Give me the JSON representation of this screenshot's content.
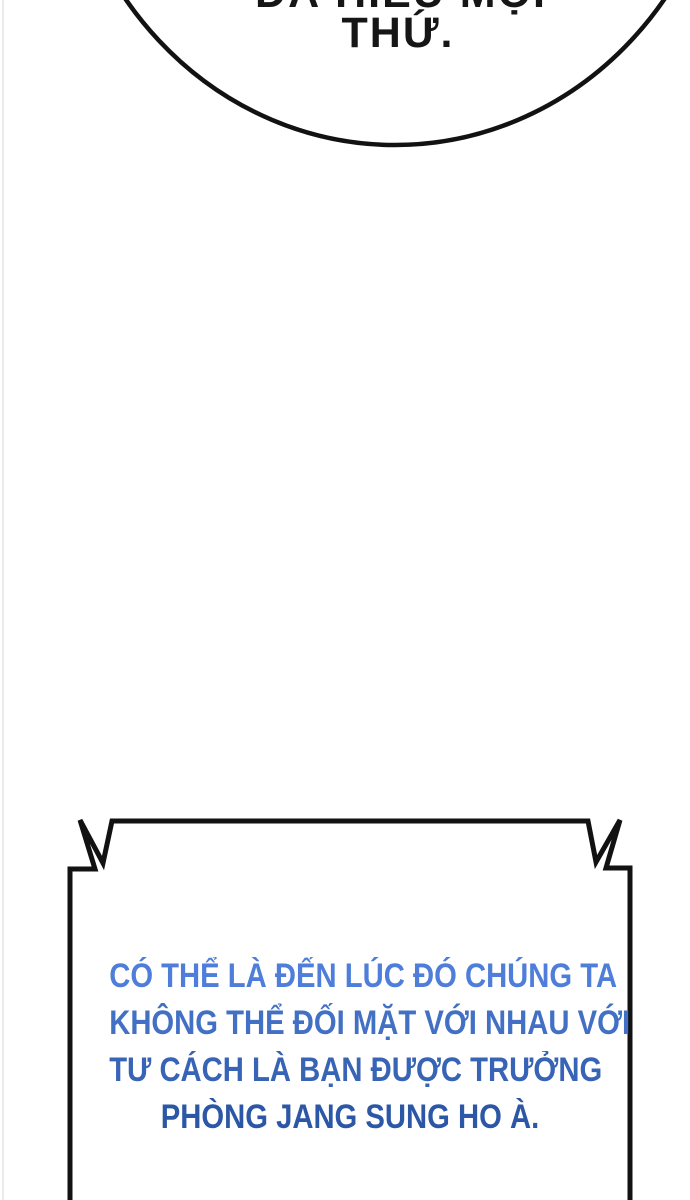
{
  "page": {
    "background_color": "#ffffff",
    "left_edge_line_color": "#eaeaea"
  },
  "top_speech_bubble": {
    "shape": "ellipse-cut-off-at-top",
    "outline_color": "#121212",
    "fill_color": "#ffffff",
    "partial_line_text": "ĐÃ HIỂU MỌI",
    "main_line_text": "THỨ.",
    "text_color": "#161616"
  },
  "dialog_box": {
    "shape": "flash-rectangle-cut-off-at-bottom",
    "outline_color": "#121212",
    "fill_color": "#ffffff",
    "lines": [
      {
        "text": "CÓ THỂ LÀ ĐẾN LÚC ĐÓ CHÚNG TA",
        "color": "#4e7ed9"
      },
      {
        "text": "KHÔNG THỂ ĐỐI MẶT VỚI NHAU VỚI",
        "color": "#4270c4"
      },
      {
        "text": "TƯ CÁCH LÀ BẠN ĐƯỢC TRƯỞNG",
        "color": "#3764b5"
      },
      {
        "text": "PHÒNG JANG SUNG HO À.",
        "color": "#2b57a6"
      }
    ]
  }
}
